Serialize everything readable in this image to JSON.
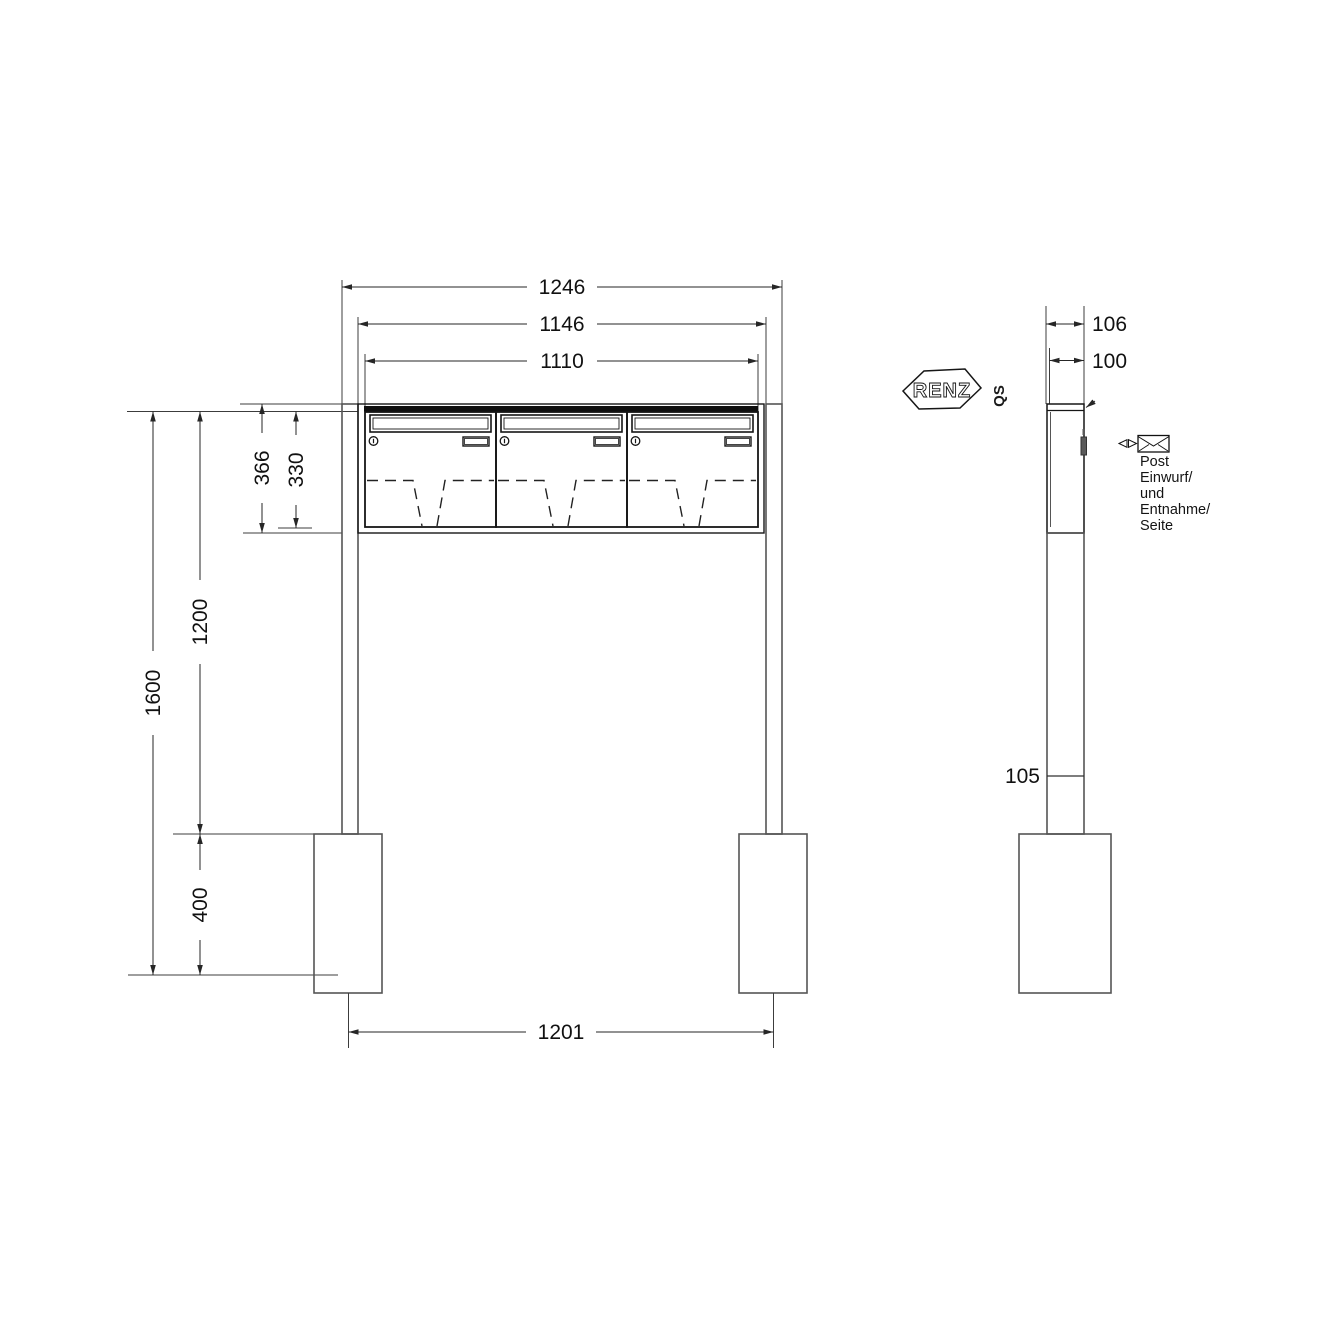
{
  "drawing": {
    "front": {
      "dims": {
        "overall_width": "1246",
        "body_width": "1146",
        "boxes_width": "1110",
        "unit_height": "366",
        "door_height": "330",
        "total_height": "1600",
        "free_height": "1200",
        "anchor_depth": "400",
        "post_spacing": "1201"
      }
    },
    "side": {
      "dims": {
        "overall_depth": "106",
        "body_depth": "100",
        "post_depth": "105"
      },
      "note_lines": [
        "Post",
        "Einwurf/",
        "und",
        "Entnahme/",
        "Seite"
      ]
    },
    "brand": {
      "name": "RENZ",
      "qs": "QS"
    },
    "colors": {
      "ink": "#1a1a1a",
      "structure": "#555555",
      "background": "#ffffff"
    }
  }
}
